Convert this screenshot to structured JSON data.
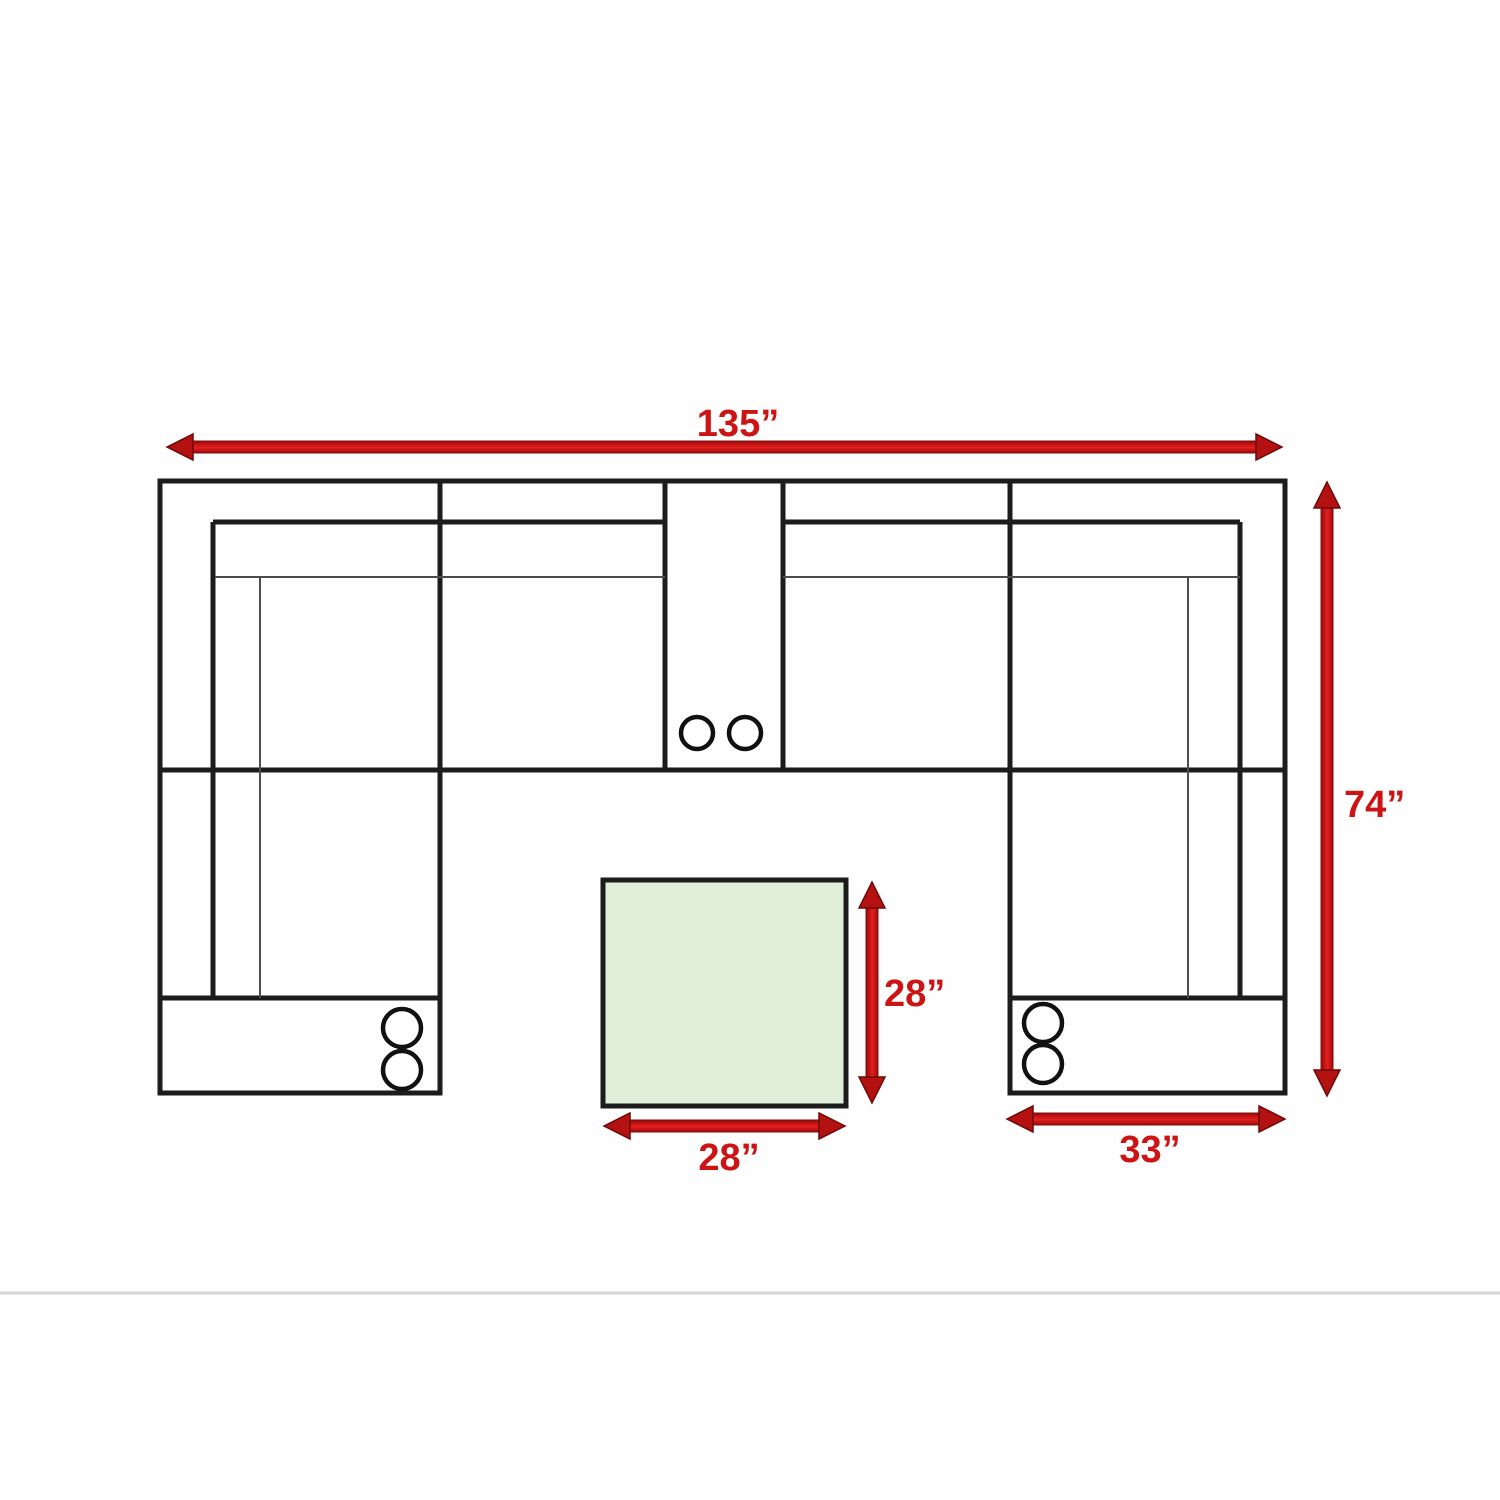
{
  "diagram": {
    "name": "sectional-sofa-dimension-floor-plan",
    "units": "inches",
    "labels": {
      "total_width": "135”",
      "total_depth": "74”",
      "ottoman_depth": "28”",
      "ottoman_width": "28”",
      "chaise_width": "33”"
    },
    "values": {
      "total_width_in": 135,
      "total_depth_in": 74,
      "ottoman_width_in": 28,
      "ottoman_depth_in": 28,
      "chaise_width_in": 33
    },
    "colors": {
      "arrow_red": "#c81212",
      "arrow_red_dark": "#7a0d0d",
      "label_red": "#cd1414",
      "ottoman_green": "#e1eed9",
      "outline_black": "#1c1c1c",
      "thin_line_gray": "#4d4d4d",
      "divider_gray": "#d6d6d6"
    },
    "cupholder_pairs": 3
  }
}
